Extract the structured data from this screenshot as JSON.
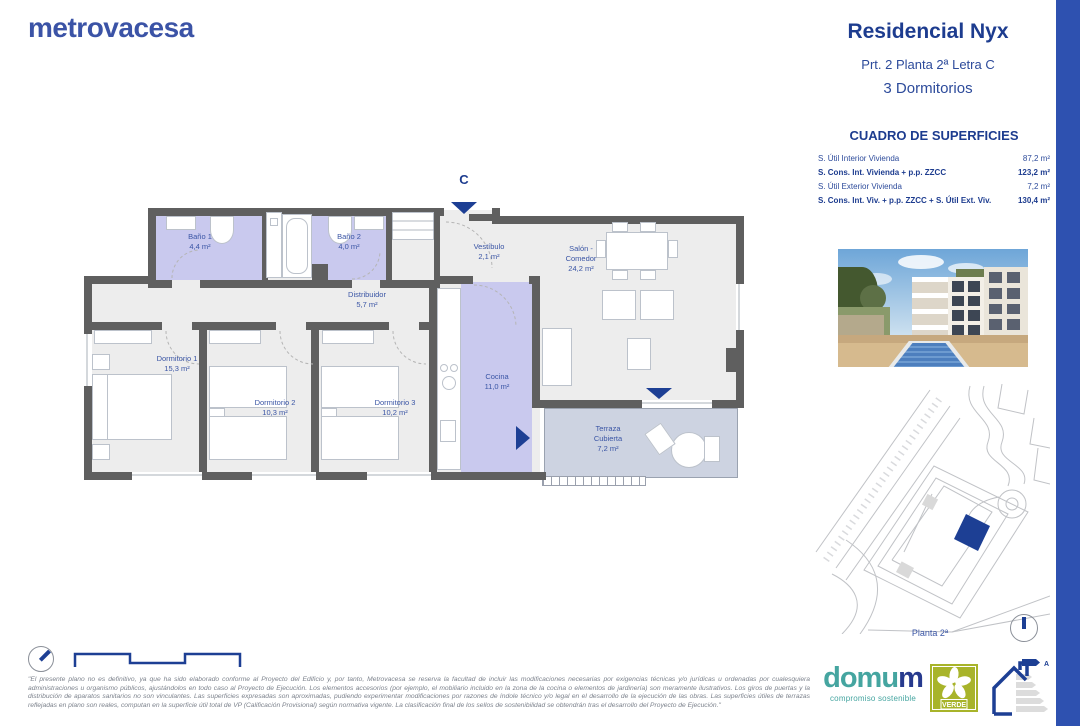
{
  "brand": {
    "logo_text": "metrovacesa"
  },
  "header": {
    "title": "Residencial Nyx",
    "subtitle": "Prt. 2 Planta 2ª Letra C",
    "type": "3 Dormitorios"
  },
  "surfaces": {
    "title": "CUADRO DE SUPERFICIES",
    "rows": [
      {
        "label": "S. Útil Interior Vivienda",
        "value": "87,2 m²"
      },
      {
        "label": "S. Cons. Int. Vivienda + p.p. ZZCC",
        "value": "123,2 m²"
      },
      {
        "label": "S. Útil Exterior Vivienda",
        "value": "7,2 m²"
      },
      {
        "label": "S. Cons. Int. Viv. + p.p. ZZCC + S. Útil Ext. Viv.",
        "value": "130,4 m²"
      }
    ]
  },
  "floorplan": {
    "entrance_marker": "C",
    "rooms": [
      {
        "name": "Baño 1",
        "area": "4,4 m²"
      },
      {
        "name": "Baño 2",
        "area": "4,0 m²"
      },
      {
        "name": "Distribuidor",
        "area": "5,7 m²"
      },
      {
        "name": "Vestíbulo",
        "area": "2,1 m²"
      },
      {
        "name": "Salón - Comedor",
        "area": "24,2 m²"
      },
      {
        "name": "Dormitorio 1",
        "area": "15,3 m²"
      },
      {
        "name": "Dormitorio 2",
        "area": "10,3 m²"
      },
      {
        "name": "Dormitorio 3",
        "area": "10,2 m²"
      },
      {
        "name": "Cocina",
        "area": "11,0 m²"
      },
      {
        "name": "Terraza Cubierta",
        "area": "7,2 m²"
      }
    ]
  },
  "siteplan": {
    "floor_label": "Planta 2ª"
  },
  "footer": {
    "disclaimer": "\"El presente plano no es definitivo, ya que ha sido elaborado conforme al Proyecto del Edificio y, por tanto, Metrovacesa se reserva la facultad de incluir las modificaciones necesarias por exigencias técnicas y/o jurídicas u ordenadas por cualesquiera administraciones u organismo públicos, ajustándolos en todo caso al Proyecto de Ejecución. Los elementos accesorios (por ejemplo, el mobiliario incluido en la zona de la cocina o elementos de jardinería) son meramente ilustrativos. Los giros de puertas y la distribución de aparatos sanitarios no son vinculantes. Las superficies expresadas son aproximadas, pudiendo experimentar modificaciones por razones de índole técnico y/o legal en el desarrollo de la ejecución de las obras. Las superficies útiles de terrazas reflejadas en plano son reales, computan en la superficie útil total de VP (Calificación Provisional) según normativa vigente. La clasificación final de los sellos de sostenibilidad se obtendrán tras el desarrollo del Proyecto de Ejecución.\"",
    "domum_part1": "domu",
    "domum_part2": "m",
    "domum_tagline": "compromiso sostenible",
    "verde_label": "VERDE",
    "energy_grade": "A"
  },
  "colors": {
    "brand_blue": "#3b53a6",
    "navy": "#1d3c8f",
    "accent_bar": "#2e51b0",
    "teal": "#45a5a0",
    "verde_green": "#a8b42a",
    "wall_gray": "#5f5f5f",
    "room_lavender": "#c9c9ee",
    "terrace_blue_gray": "#cdd3e1"
  }
}
